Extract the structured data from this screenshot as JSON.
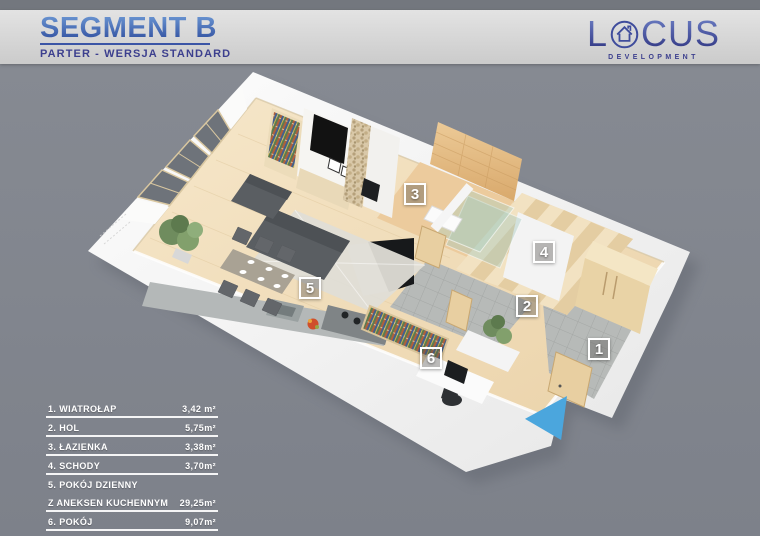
{
  "header": {
    "title": "SEGMENT B",
    "subtitle": "PARTER - WERSJA STANDARD"
  },
  "logo": {
    "word_start": "L",
    "word_end": "CUS",
    "subtext": "DEVELOPMENT",
    "icon": "house-in-circle"
  },
  "legend": {
    "rows": [
      {
        "label": "1. WIATROŁAP",
        "value": "3,42 m²",
        "underline": true,
        "indent": false
      },
      {
        "label": "2. HOL",
        "value": "5,75m²",
        "underline": true,
        "indent": false
      },
      {
        "label": "3. ŁAZIENKA",
        "value": "3,38m²",
        "underline": true,
        "indent": false
      },
      {
        "label": "4. SCHODY",
        "value": "3,70m²",
        "underline": true,
        "indent": false
      },
      {
        "label": "5. POKÓJ DZIENNY",
        "value": "",
        "underline": false,
        "indent": false
      },
      {
        "label": "Z ANEKSEN KUCHENNYM",
        "value": "29,25m²",
        "underline": true,
        "indent": false
      },
      {
        "label": "6. POKÓJ",
        "value": "9,07m²",
        "underline": true,
        "indent": false
      },
      {
        "label": "SUMA POWIERZCHNI",
        "value": "54,57m²",
        "underline": true,
        "indent": true
      }
    ]
  },
  "plan": {
    "markers": [
      {
        "number": "1",
        "x": 599,
        "y": 349
      },
      {
        "number": "2",
        "x": 527,
        "y": 306
      },
      {
        "number": "3",
        "x": 415,
        "y": 194
      },
      {
        "number": "4",
        "x": 544,
        "y": 252
      },
      {
        "number": "5",
        "x": 310,
        "y": 288
      },
      {
        "number": "6",
        "x": 431,
        "y": 358
      }
    ],
    "entrance_arrow": {
      "direction": "left",
      "color": "#4BA6DD"
    }
  },
  "colors": {
    "background": "#82868E",
    "banner": "#D9D9D9",
    "title_blue": "#3E68B2",
    "subtitle_navy": "#3C3F8E",
    "legend_text": "#FFFFFF",
    "arrow_blue": "#4BA6DD",
    "wall_white": "#F4F4F4",
    "floor_wood": "#F0DCBB",
    "tile_gray": "#B7BAB8",
    "bath_tile": "#E2B583"
  }
}
